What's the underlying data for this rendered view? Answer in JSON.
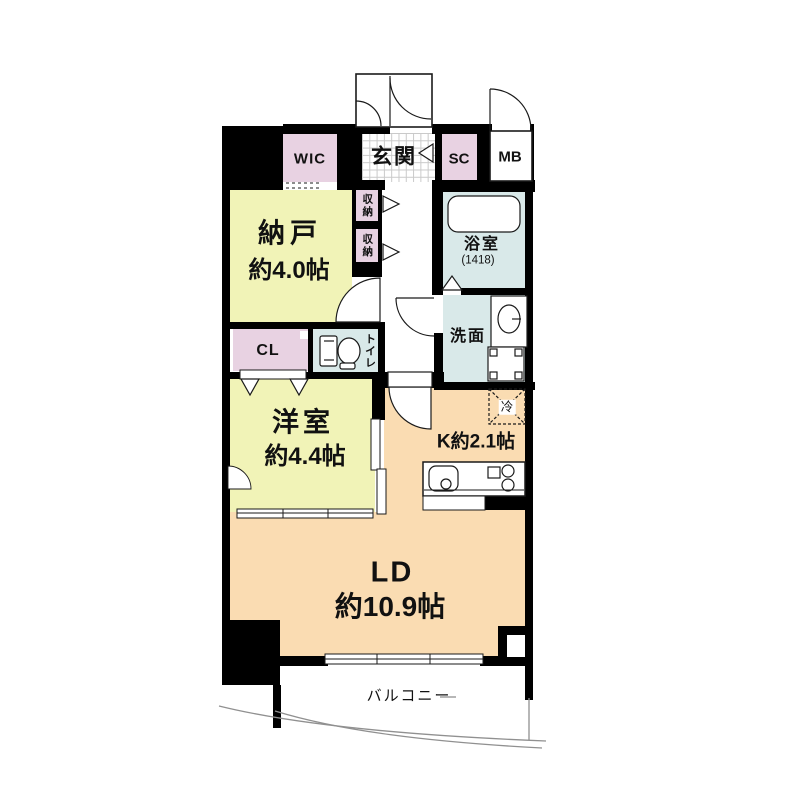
{
  "plan": {
    "title": "apartment-floor-plan",
    "rooms": {
      "wic": {
        "label": "WIC"
      },
      "genkan": {
        "label": "玄関"
      },
      "sc": {
        "label": "SC"
      },
      "mb": {
        "label": "MB"
      },
      "nando": {
        "label": "納戸",
        "size": "約4.0帖"
      },
      "shuno_upper": {
        "label": "収納"
      },
      "shuno_lower": {
        "label": "収納"
      },
      "bathroom": {
        "label": "浴室",
        "size": "(1418)"
      },
      "senmen": {
        "label": "洗面"
      },
      "toilet": {
        "label": "トイレ"
      },
      "cl": {
        "label": "CL"
      },
      "yoshitsu": {
        "label": "洋室",
        "size": "約4.4帖"
      },
      "kitchen": {
        "label": "K約2.1帖"
      },
      "refrigerator": {
        "label": "冷"
      },
      "ld": {
        "label": "LD",
        "size": "約10.9帖"
      },
      "balcony": {
        "label": "バルコニー"
      }
    },
    "colors": {
      "wall": "#000000",
      "closet_pink": "#e8d2e2",
      "room_yellow": "#f1f3b7",
      "wet_blue": "#d9e9e9",
      "living_peach": "#fadcb2",
      "line_gray": "#909090",
      "tile_gray": "#c9c9c9"
    }
  }
}
